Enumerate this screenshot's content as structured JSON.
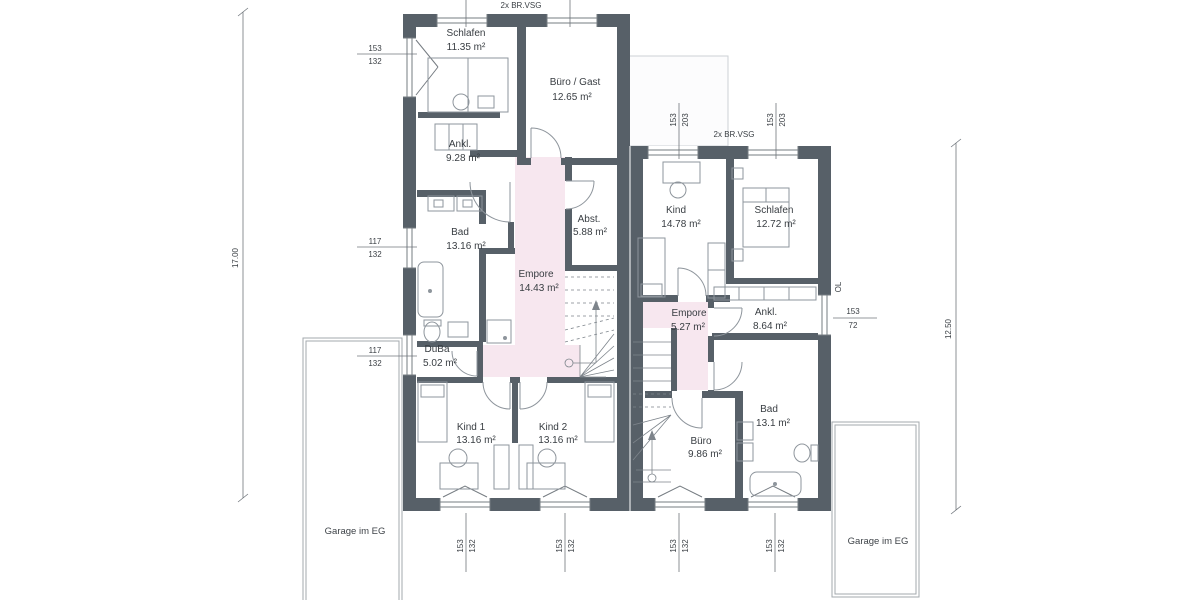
{
  "units": {
    "left": {
      "rooms": [
        {
          "name": "Schlafen",
          "area": "11.35 m²"
        },
        {
          "name": "Büro / Gast",
          "area": "12.65 m²"
        },
        {
          "name": "Ankl.",
          "area": "9.28 m²"
        },
        {
          "name": "Bad",
          "area": "13.16 m²"
        },
        {
          "name": "Abst.",
          "area": "5.88 m²"
        },
        {
          "name": "Empore",
          "area": "14.43 m²"
        },
        {
          "name": "DuBa",
          "area": "5.02 m²"
        },
        {
          "name": "Kind 1",
          "area": "13.16 m²"
        },
        {
          "name": "Kind 2",
          "area": "13.16 m²"
        }
      ]
    },
    "right": {
      "rooms": [
        {
          "name": "Kind",
          "area": "14.78 m²"
        },
        {
          "name": "Schlafen",
          "area": "12.72 m²"
        },
        {
          "name": "Empore",
          "area": "5.27 m²"
        },
        {
          "name": "Ankl.",
          "area": "8.64 m²"
        },
        {
          "name": "Bad",
          "area": "13.1 m²"
        },
        {
          "name": "Büro",
          "area": "9.86 m²"
        }
      ]
    }
  },
  "annotations": {
    "glazing_left": "2x BR.VSG",
    "glazing_right": "2x BR.VSG",
    "garage_left": "Garage im EG",
    "garage_right": "Garage im EG",
    "skylight": "OL"
  },
  "dims": {
    "total_left": "17.00",
    "total_right": "12.50",
    "window_labels": {
      "left_side": [
        {
          "w": "153",
          "h": "132"
        },
        {
          "w": "117",
          "h": "132"
        },
        {
          "w": "117",
          "h": "132"
        }
      ],
      "bottom": [
        {
          "w": "153",
          "h": "132"
        },
        {
          "w": "153",
          "h": "132"
        },
        {
          "w": "153",
          "h": "132"
        },
        {
          "w": "153",
          "h": "132"
        }
      ],
      "top_right": [
        {
          "w": "153",
          "h": "203"
        },
        {
          "w": "153",
          "h": "203"
        }
      ],
      "right_side": [
        {
          "w": "153",
          "h": "72"
        }
      ]
    }
  },
  "colors": {
    "wall": "#576068",
    "empore": "#f7e7ef",
    "furniture_line": "#8e959c"
  }
}
